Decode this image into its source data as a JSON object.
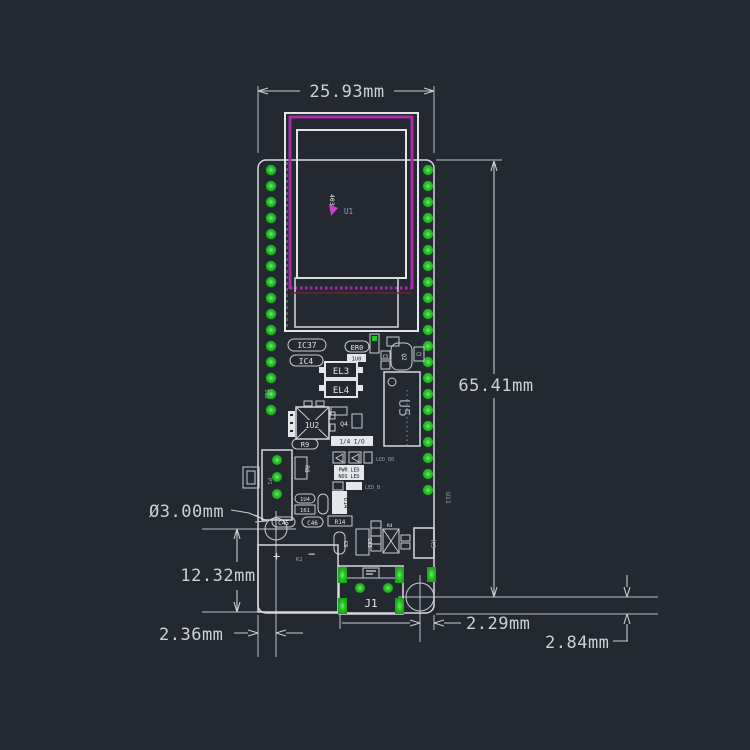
{
  "dimensions": {
    "board_width": "25.93mm",
    "board_length": "65.41mm",
    "hole_diameter": "Ø3.00mm",
    "hole_left_offset_y": "12.32mm",
    "hole_left_offset_x": "2.36mm",
    "hole_right_offset_x": "2.29mm",
    "hole_right_offset_y": "2.84mm"
  },
  "silkscreen": {
    "u1": "U1",
    "marker": "403",
    "ic37": "IC37",
    "ic4": "IC4",
    "er0": "ER0",
    "u0": "1U0",
    "c2": "C2",
    "c5": "C5",
    "q2": "Q2",
    "el3": "EL3",
    "el4": "EL4",
    "u5": "U5",
    "i12": "I12",
    "u2": "1U2",
    "q4": "Q4",
    "io": "1/4 I/O",
    "led_b0": "LED_B0",
    "pwr_led": "PWR LED",
    "nos_led": "NOS LED",
    "led_b": "LED_B",
    "r9": "R9",
    "r8": "R8",
    "u14": "U14",
    "u4": "1U4",
    "n161": "161",
    "c45": "C45",
    "c46": "C46",
    "r14": "R14",
    "c8": "C8",
    "c63": "C63",
    "r4": "R4",
    "k3": "K3",
    "k2": "K2",
    "plus": "+",
    "minus": "−",
    "j1": "J1",
    "u11": "U11",
    "p1": "P1"
  },
  "colors": {
    "background": "#232831",
    "dimension_line": "#c9ced4",
    "outline_white": "#d6d9de",
    "pad_green": "#22c522",
    "display_magenta": "#a82ba8",
    "marker_magenta": "#d23ad2",
    "text_gray": "#9aa1ab",
    "inner_layer_red": "#6e2222"
  }
}
